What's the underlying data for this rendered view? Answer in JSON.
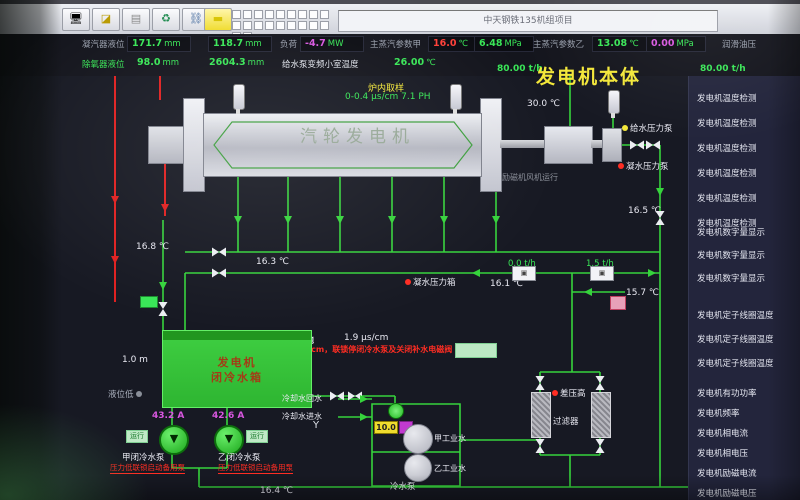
{
  "window": {
    "title": "中天钢铁135机组项目"
  },
  "toolbar": {
    "icons": [
      "monitor-icon",
      "back-icon",
      "picture-icon",
      "refresh-icon",
      "link-icon",
      "note-icon"
    ],
    "glyphs": [
      "🖥",
      "◪",
      "▤",
      "♻",
      "⛓",
      "▬"
    ]
  },
  "status": {
    "row1": {
      "l1": "凝汽器液位",
      "v1": "171.7",
      "u1": "mm",
      "v2": "118.7",
      "u2": "mm",
      "l2": "负荷",
      "v3": "-4.7",
      "u3": "MW",
      "l3": "主蒸汽参数甲",
      "v4": "16.0",
      "u4": "℃",
      "v5": "6.48",
      "u5": "MPa",
      "l4": "主蒸汽参数乙",
      "v6": "13.08",
      "u6": "℃",
      "v7": "0.00",
      "u7": "MPa",
      "l5": "润滑油压"
    },
    "row2": {
      "l1": "除氧器液位",
      "v1": "98.0",
      "u1": "mm",
      "v2": "2604.3",
      "u2": "mm",
      "l2": "给水泵变频小室温度",
      "v3": "26.00",
      "u3": "℃",
      "flow_left": "80.00 t/h",
      "flow_right": "80.00 t/h"
    }
  },
  "diagram": {
    "title": "发电机本体",
    "turbine": "汽轮发电机",
    "sample_title": "炉内取样",
    "sample_value": "0-0.4 μs/cm  7.1 PH",
    "temp_exciter": "30.0 ℃",
    "exciter_fan": "励磁机风机运行",
    "feed_pump": "给水压力泵",
    "cond_pump": "凝水压力泵",
    "cond_tank": "凝水压力箱",
    "t_165": "16.5 ℃",
    "t_168": "16.8 ℃",
    "t_163": "16.3 ℃",
    "t_161": "16.1 ℃",
    "t_157": "15.7 ℃",
    "t_164": "16.4 ℃",
    "f_0": "0.0 t/h",
    "f_15": "1.5 t/h",
    "ground_label": "接地",
    "ground_value": "1.9 μs/cm",
    "alarm_text": "电导率大于2μs/cm，联锁停闭冷水泵及关闭补水电磁阀",
    "tank_line1": "发电机",
    "tank_line2": "闭冷水箱",
    "tank_level": "1.0 m",
    "level_low": "液位低",
    "pump_a_current": "43.2 A",
    "pump_b_current": "42.6 A",
    "pump_a_status": "运行",
    "pump_b_status": "运行",
    "pump_a_label": "甲闭冷水泵",
    "pump_b_label": "乙闭冷水泵",
    "pump_a_alarm": "压力低联锁启动备用泵",
    "pump_b_alarm": "压力低联锁启动备用泵",
    "cooling_return": "冷却水回水",
    "cooling_inlet": "冷却水进水",
    "valve_value": "10.0",
    "y_symbol": "Y",
    "ind_water_a": "甲工业水",
    "ind_water_b": "乙工业水",
    "cold_pump": "冷水泵",
    "dp_high": "差压高",
    "filter_label": "过滤器"
  },
  "sidebar": {
    "g1": [
      "发电机温度检测",
      "发电机温度检测",
      "发电机温度检测",
      "发电机温度检测",
      "发电机温度检测",
      "发电机温度检测"
    ],
    "g2": [
      "发电机数字量显示",
      "发电机数字量显示",
      "发电机数字量显示"
    ],
    "g3": [
      "发电机定子线圈温度",
      "发电机定子线圈温度",
      "发电机定子线圈温度"
    ],
    "g4": [
      "发电机有功功率",
      "发电机频率",
      "发电机相电流",
      "发电机相电压",
      "发电机励磁电流",
      "发电机励磁电压"
    ]
  },
  "colors": {
    "pipe_green": "#36d33c",
    "pipe_red": "#e02020",
    "accent_yellow": "#f3e73a",
    "value_green": "#39e657",
    "value_magenta": "#d957e0"
  }
}
